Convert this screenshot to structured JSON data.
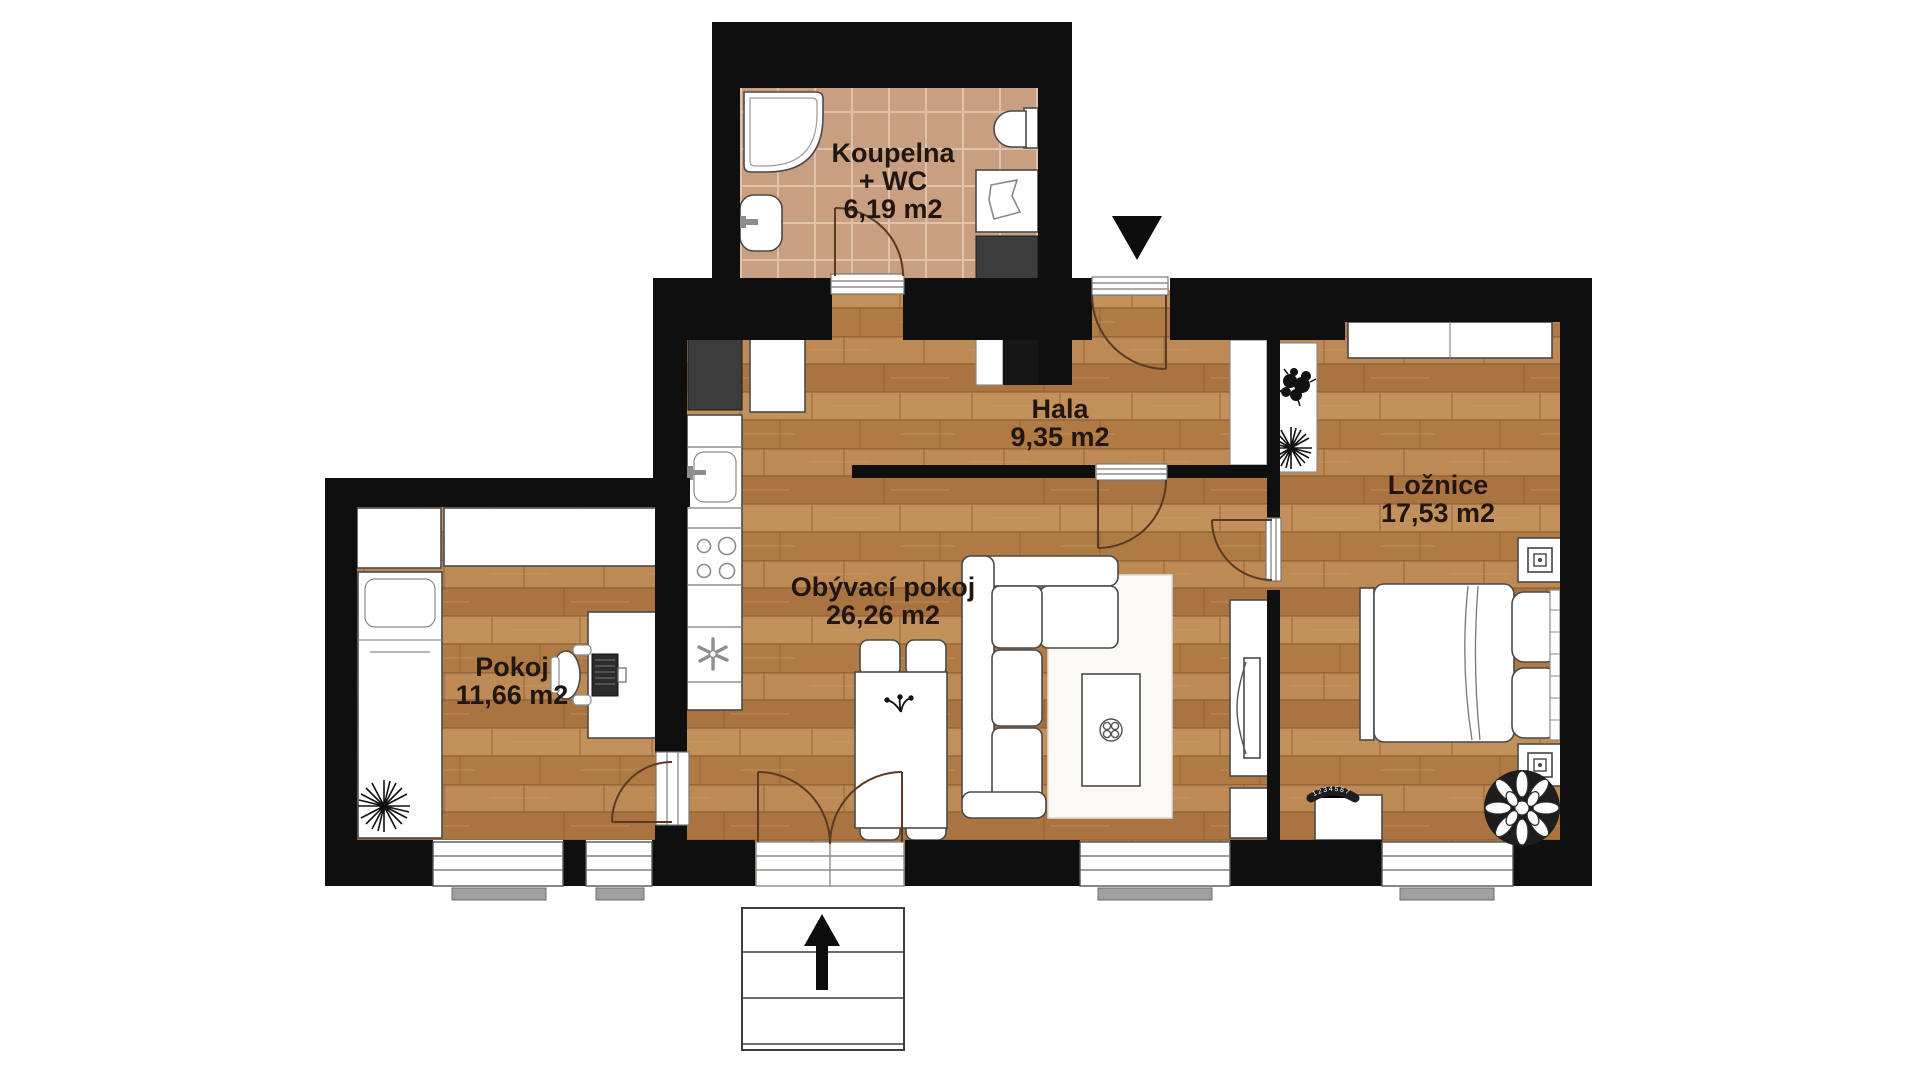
{
  "type": "apartment-floor-plan",
  "language": "cs",
  "rooms": {
    "koupelna": {
      "label": "Koupelna",
      "label2": "+ WC",
      "area": "6,19 m2"
    },
    "hala": {
      "label": "Hala",
      "area": "9,35 m2"
    },
    "loznice": {
      "label": "Ložnice",
      "area": "17,53 m2"
    },
    "obyvaci_pokoj": {
      "label": "Obývací pokoj",
      "area": "26,26 m2"
    },
    "pokoj": {
      "label": "Pokoj",
      "area": "11,66 m2"
    }
  },
  "annotations": {
    "radiator_dial_numbers": "1234567"
  },
  "icons": {
    "entrance-arrow": "▼",
    "stairs-up-arrow": "▲",
    "fan-icon": "✳",
    "plant-icon": "✺"
  },
  "colors": {
    "background": "#ffffff",
    "wall": "#0f0f0f",
    "wood_floor": "#b5824e",
    "tile_floor": "#c99f82",
    "furniture_fill": "#ffffff",
    "furniture_stroke": "#4a4a4a",
    "door_arc": "#5a3a22",
    "label_text": "#221610"
  }
}
